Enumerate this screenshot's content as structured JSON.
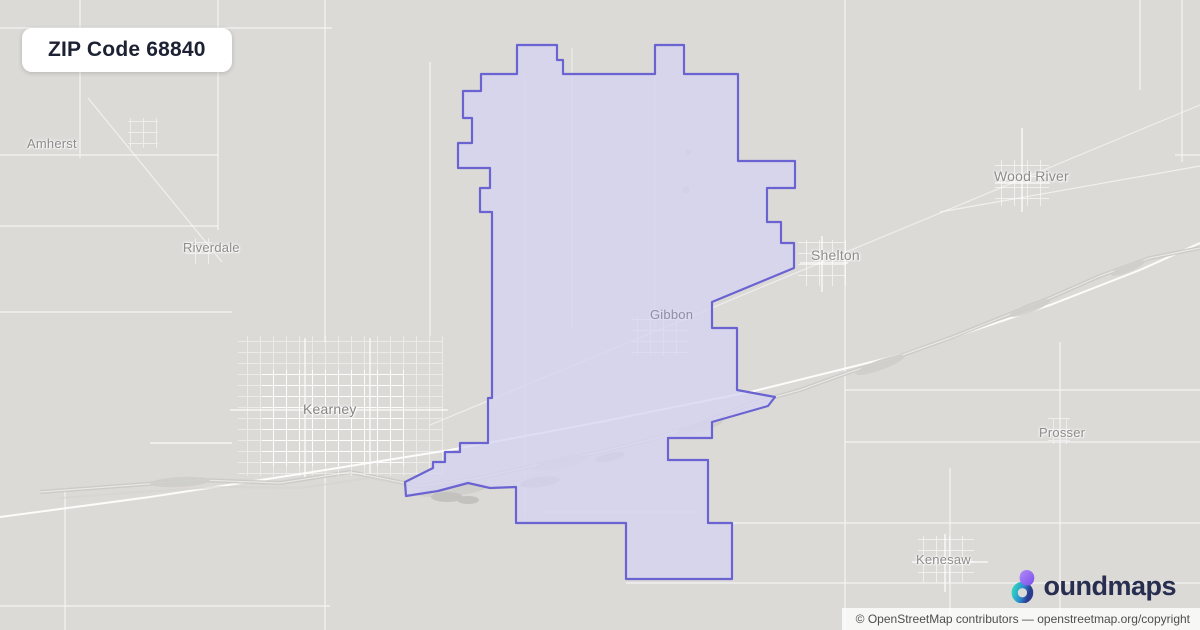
{
  "badge": {
    "title": "ZIP Code 68840"
  },
  "map": {
    "labels": {
      "amherst": "Amherst",
      "riverdale": "Riverdale",
      "kearney": "Kearney",
      "gibbon": "Gibbon",
      "shelton": "Shelton",
      "wood_river": "Wood River",
      "prosser": "Prosser",
      "kenesaw": "Kenesaw"
    },
    "zip_boundary": {
      "zip_code": "68840",
      "stroke": "#6a63d1",
      "fill_tint": "#d5d3f1"
    }
  },
  "logo": {
    "brand": "boundmaps",
    "wordmark_text": "oundmaps"
  },
  "footer": {
    "attribution": "© OpenStreetMap contributors — openstreetmap.org/copyright"
  }
}
